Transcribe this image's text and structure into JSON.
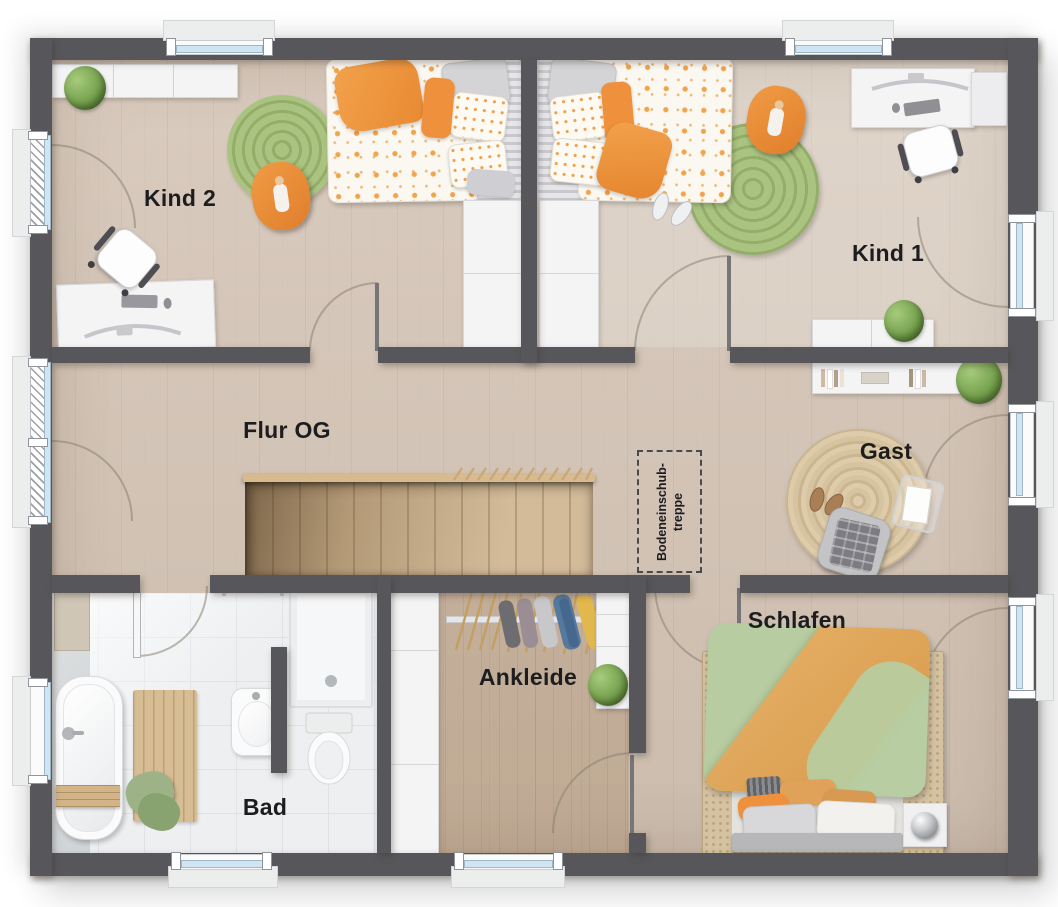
{
  "floorplan": {
    "rooms": [
      {
        "id": "kind2",
        "label": "Kind 2"
      },
      {
        "id": "kind1",
        "label": "Kind 1"
      },
      {
        "id": "flur-og",
        "label": "Flur OG"
      },
      {
        "id": "gast",
        "label": "Gast"
      },
      {
        "id": "bad",
        "label": "Bad"
      },
      {
        "id": "ankleide",
        "label": "Ankleide"
      },
      {
        "id": "schlafen",
        "label": "Schlafen"
      }
    ],
    "annotations": {
      "attic_hatch": {
        "line1": "Bodeneinschub-",
        "line2": "treppe"
      }
    },
    "colors": {
      "wall": "#57575b",
      "floor_wood": "#d6c7b9",
      "floor_tile": "#edeff1",
      "stair_wood": "#cdb28c",
      "rail_wood": "#d7ba8e",
      "accent_orange": "#ef913c",
      "rug_green": "#a3bd7b",
      "bed_green": "#b7cda1",
      "rug_jute": "#d5c2a0",
      "glass_blue": "#cfe5f3",
      "furniture_white": "#f4f4f5",
      "label_ink": "#1d1d1f"
    }
  }
}
